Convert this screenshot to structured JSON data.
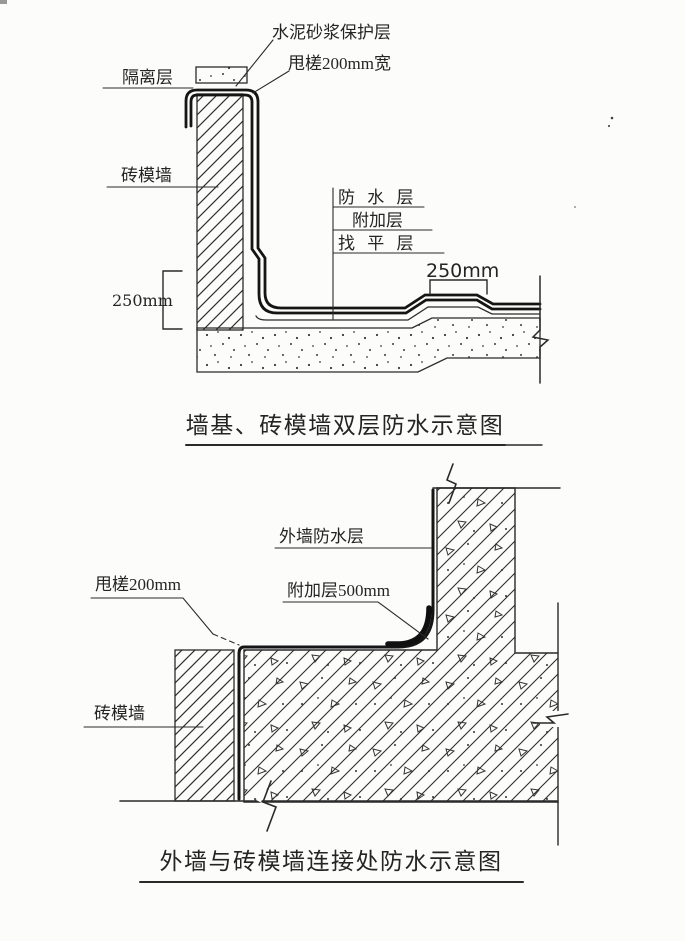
{
  "page": {
    "background": "#fcfcfa",
    "ink": "#2a2a2a"
  },
  "diagram1": {
    "title": "墙基、砖模墙双层防水示意图",
    "labels": {
      "protective_layer": "水泥砂浆保护层",
      "overlap_edge": "甩槎200mm宽",
      "isolation_layer": "隔离层",
      "brick_form_wall": "砖模墙",
      "waterproof_layer": "防 水 层",
      "additional_layer": "附加层",
      "leveling_layer": "找 平 层",
      "dim_left": "250mm",
      "dim_right": "250mm"
    }
  },
  "diagram2": {
    "title": "外墙与砖模墙连接处防水示意图",
    "labels": {
      "exterior_waterproof_layer": "外墙防水层",
      "overlap_edge": "甩槎200mm",
      "additional_layer": "附加层500mm",
      "brick_form_wall": "砖模墙"
    }
  }
}
